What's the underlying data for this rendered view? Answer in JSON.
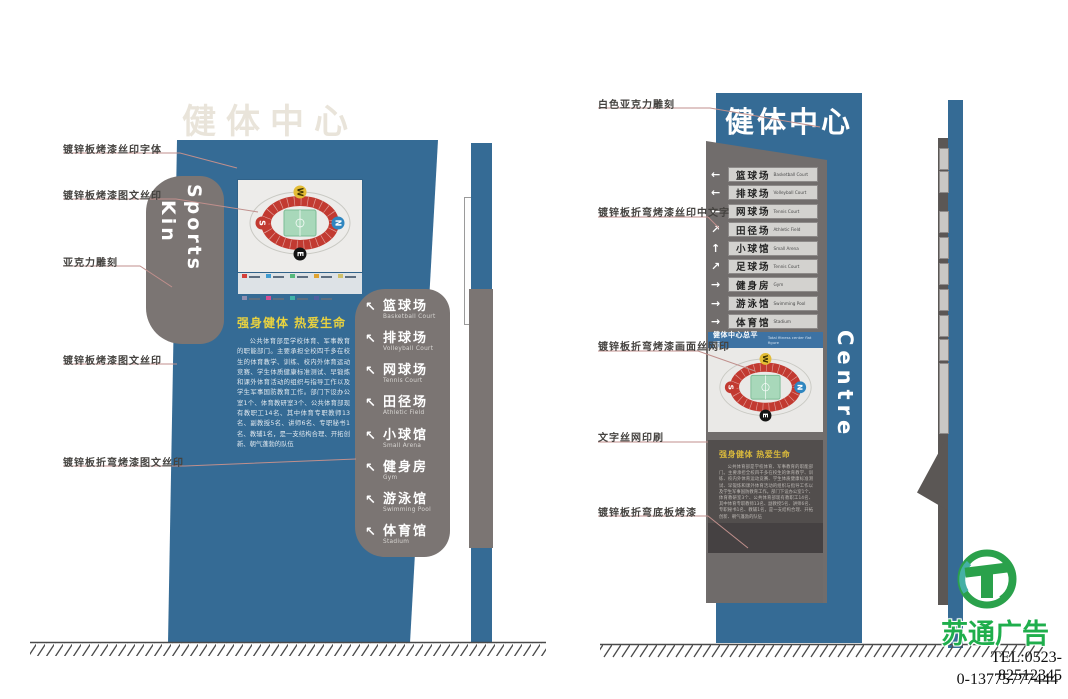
{
  "watermark": "健体中心",
  "slogan": "强身健体 热爱生命",
  "about_text": "公共体育部是学校体育、军事教育的职能部门。主要承担全校四千多在校生的体育教学、训练、校内外体育运动竞赛、学生体质健康标准测试、早锻炼和课外体育活动的组织与指导工作以及学生军事国防教育工作。部门下设办公室1个、体育教研室3个、公共体育部现有教职工14名、其中体育专职教师13名、副教授5名、讲师6名、专职秘书1名、教辅1名，是一支结构合理、开拓创新、朝气蓬勃的队伍",
  "compass": {
    "top": "W",
    "bottom": "E",
    "left": "S",
    "right": "N"
  },
  "left_pylon": {
    "tab_word_1": "Sports",
    "tab_word_2": "Kin",
    "map_legend": [
      "#d4403a",
      "#3f9bd0",
      "#56b87c",
      "#e0a330",
      "#cfc06a",
      "#8f8fb0",
      "#d44f93",
      "#3fb3a8",
      "#4f5fa0"
    ],
    "directory": [
      {
        "cn": "篮球场",
        "en": "Basketball Court",
        "arrow": "↖"
      },
      {
        "cn": "排球场",
        "en": "Volleyball Court",
        "arrow": "↖"
      },
      {
        "cn": "网球场",
        "en": "Tennis Court",
        "arrow": "↖"
      },
      {
        "cn": "田径场",
        "en": "Athletic Field",
        "arrow": "↖"
      },
      {
        "cn": "小球馆",
        "en": "Small Arena",
        "arrow": "↖"
      },
      {
        "cn": "健身房",
        "en": "Gym",
        "arrow": "↖"
      },
      {
        "cn": "游泳馆",
        "en": "Swimming Pool",
        "arrow": "↖"
      },
      {
        "cn": "体育馆",
        "en": "Stadium",
        "arrow": "↖"
      }
    ],
    "callouts": [
      "镀锌板烤漆丝印字体",
      "镀锌板烤漆图文丝印",
      "亚克力雕刻",
      "镀锌板烤漆图文丝印",
      "镀锌板折弯烤漆图文丝印"
    ]
  },
  "right_pylon": {
    "title": "健体中心",
    "side_label": "Centre",
    "map_header_cn": "健体中心总平面",
    "map_header_en": "Total fitness center flat figure",
    "directory": [
      {
        "cn": "篮球场",
        "en": "Basketball Court",
        "arrow": "←"
      },
      {
        "cn": "排球场",
        "en": "Volleyball Court",
        "arrow": "←"
      },
      {
        "cn": "网球场",
        "en": "Tennis Court",
        "arrow": "←"
      },
      {
        "cn": "田径场",
        "en": "Athletic Field",
        "arrow": "↗"
      },
      {
        "cn": "小球馆",
        "en": "Small Arena",
        "arrow": "↑"
      },
      {
        "cn": "足球场",
        "en": "Tennis Court",
        "arrow": "↗"
      },
      {
        "cn": "健身房",
        "en": "Gym",
        "arrow": "→"
      },
      {
        "cn": "游泳馆",
        "en": "Swimming Pool",
        "arrow": "→"
      },
      {
        "cn": "体育馆",
        "en": "Stadium",
        "arrow": "→"
      }
    ],
    "callouts": [
      "白色亚克力雕刻",
      "镀锌板折弯烤漆丝印中文字",
      "镀锌板折弯烤漆画面丝网印",
      "文字丝网印刷",
      "镀锌板折弯底板烤漆"
    ]
  },
  "footer": {
    "brand": "苏通广告",
    "tel": "TEL:0523-82512345",
    "phone": "0-13775777444"
  },
  "colors": {
    "pylon_blue": "#356b95",
    "panel_gray": "#7b7573",
    "dark_section": "#524e4d",
    "slogan_yellow": "#e9d23f",
    "brand_green": "#1fae4c",
    "leader_line": "#c08f8c"
  }
}
